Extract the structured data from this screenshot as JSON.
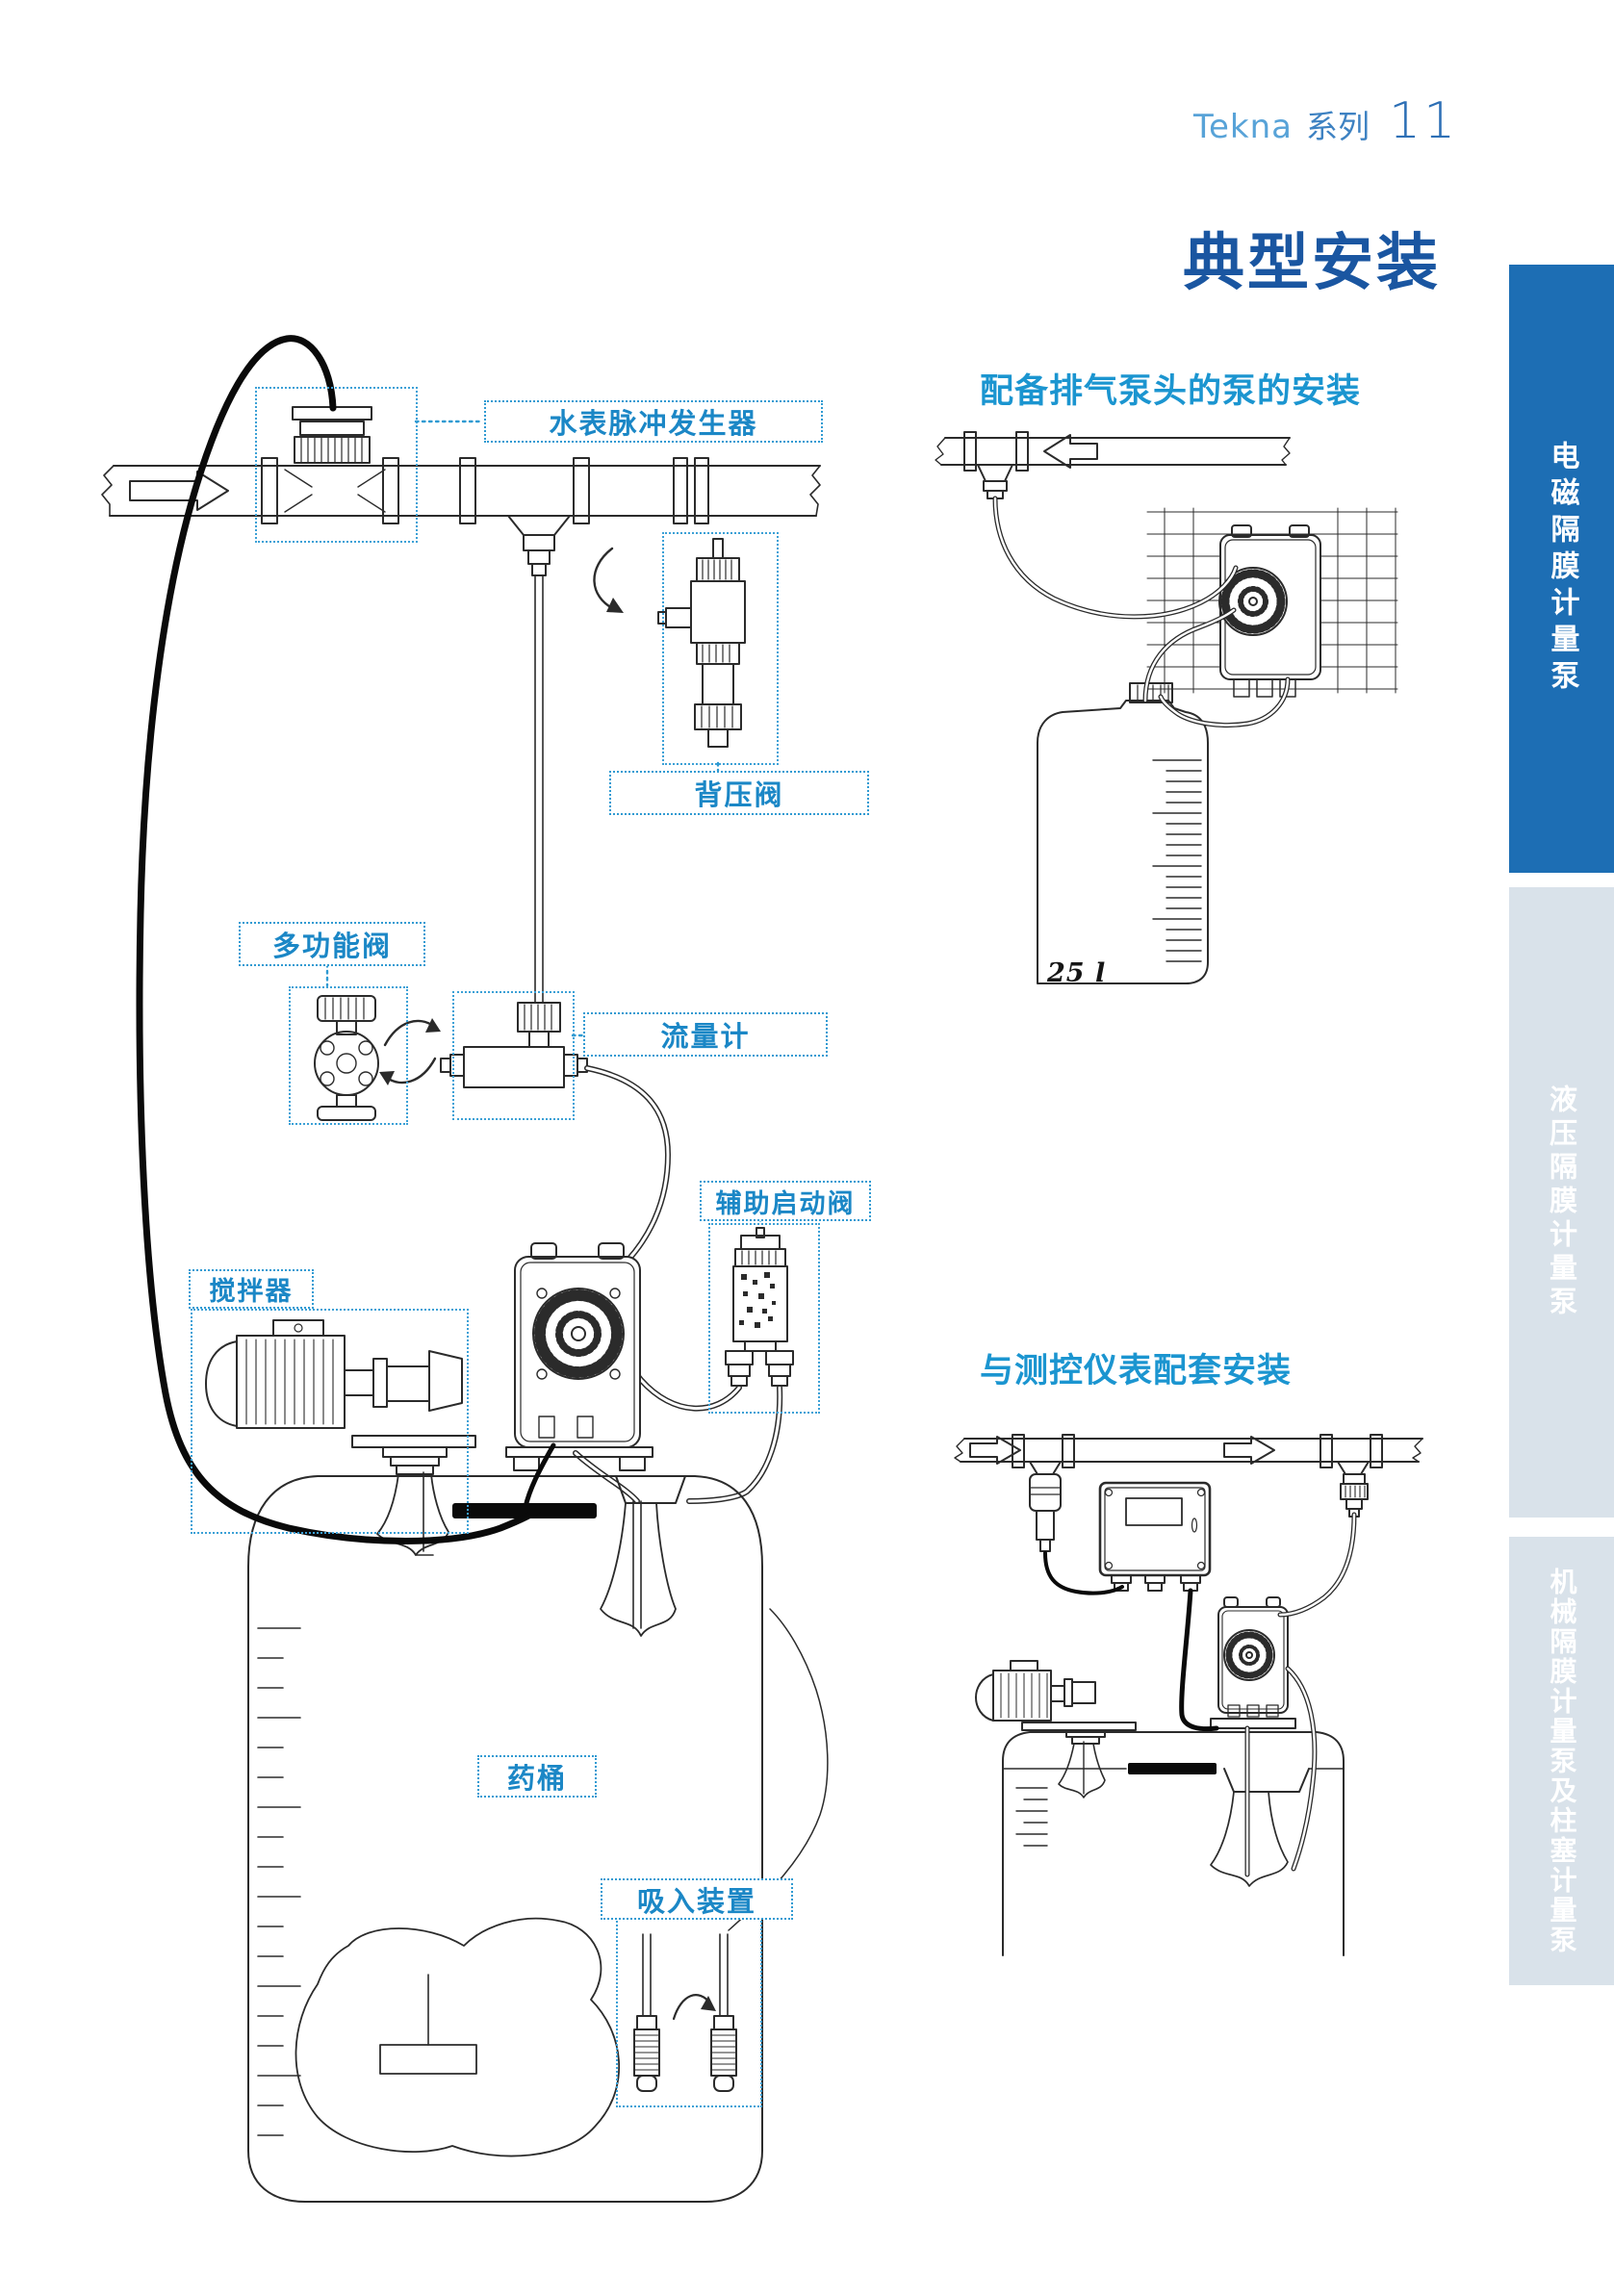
{
  "header": {
    "brand": "Tekna",
    "series": "系列",
    "page_number": "11"
  },
  "title": "典型安装",
  "sections": [
    {
      "heading": "配备排气泵头的泵的安装",
      "tank_volume_label": "25 l"
    },
    {
      "heading": "与测控仪表配套安装"
    }
  ],
  "component_labels": {
    "water_meter_pulse_generator": "水表脉冲发生器",
    "back_pressure_valve": "背压阀",
    "multifunction_valve": "多功能阀",
    "flow_meter": "流量计",
    "auxiliary_priming_valve": "辅助启动阀",
    "mixer": "搅拌器",
    "chemical_tank": "药桶",
    "suction_device": "吸入装置"
  },
  "sidebar": {
    "tabs": [
      {
        "label": "电磁隔膜计量泵",
        "active": true
      },
      {
        "label": "液压隔膜计量泵",
        "active": false
      },
      {
        "label": "机械隔膜计量泵及柱塞计量泵",
        "active": false
      }
    ]
  },
  "colors": {
    "title_blue": "#1a56a1",
    "heading_cyan": "#1b95d0",
    "label_blue": "#1b87c6",
    "dotted_border": "#2f9ad2",
    "sidebar_active_blue": "#1d6eb4",
    "sidebar_inactive_gray": "#d9e2ea",
    "line_art": "#2b2b2b"
  }
}
